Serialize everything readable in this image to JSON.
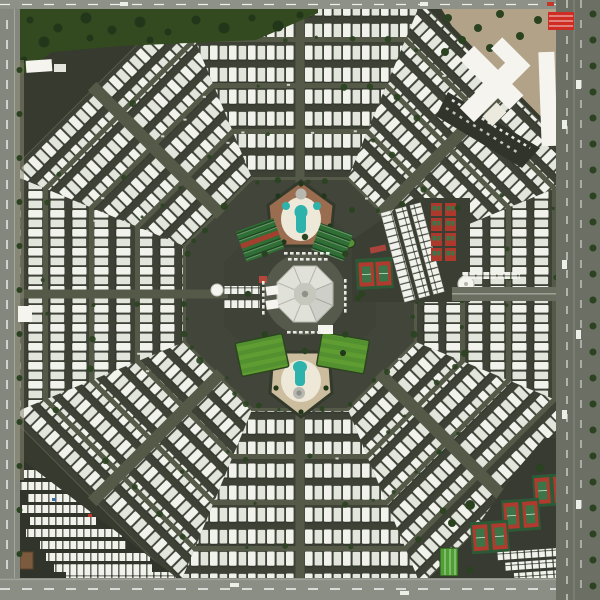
{
  "meta": {
    "type": "aerial-photograph",
    "subject": "Satellite view of an octagonal spiderweb-shaped mobile-home retirement community",
    "width_px": 600,
    "height_px": 600
  },
  "scene": {
    "colors": {
      "base": "#363a2f",
      "road": "#555948",
      "street": "#3d4136",
      "trailerA": "#f1f2ec",
      "trailerB": "#e2e5dc",
      "trailerShadow": "#20241c",
      "amenityBase": "#41453a",
      "hubBase": "#3f4337",
      "hubPlaza": "#565a4c",
      "parkGreen": "#33491f",
      "treeGreen": "#2a4220",
      "treeDark": "#22361a",
      "lawnA": "#5f9c31",
      "lawnB": "#539030",
      "canopyGreen": "#2f6e35",
      "canopyGap": "#1d4a22",
      "pool": "#2db3ac",
      "patioWhite": "#eee8d8",
      "terracotta": "#9a6c50",
      "tan": "#ccbd9e",
      "tennisPad": "#2d5a36",
      "tennisRed": "#b03a2e",
      "courtGreen": "#3c7547",
      "shuffleRed": "#ad382c",
      "roofWhite": "#e0e1d9",
      "roofEdge": "#b4b5ab",
      "roofInner": "#c6c7bd",
      "dirt": "#b1a288",
      "bldgWhite": "#f5f4ef",
      "redRoof": "#cf2d24",
      "asphalt": "#30342a",
      "zoneSE": "#373b31",
      "edgeRoadLeft": "#84877e",
      "edgeRoadBottom": "#8b8e85",
      "edgeRoadRight": "#6b6f64",
      "topRoad": "#8e9188",
      "shoulder": "#8a8672",
      "spa": "#b7b8b0",
      "shed": "#7b5a3e",
      "white": "#ffffff",
      "bocce": "#4f9f33",
      "redShed": "#a8443a"
    },
    "geometry": {
      "center": {
        "x": 300,
        "y": 294
      },
      "sectors": 8,
      "outer_apothem": 292,
      "amenity_apothem": 114,
      "hub_apothem": 76,
      "band_apothems": [
        [
          117,
          160
        ],
        [
          165,
          206
        ],
        [
          211,
          252
        ],
        [
          257,
          291
        ]
      ],
      "trailer_tile": {
        "w": 19,
        "h": 22
      }
    },
    "features": [
      {
        "name": "trailer-web",
        "label": "Concentric octagonal rings of white mobile homes"
      },
      {
        "name": "ring-roads",
        "label": "Octagonal ring roads between trailer bands"
      },
      {
        "name": "radial-roads",
        "label": "Eight radial streets from the center"
      },
      {
        "name": "central-clubhouse",
        "label": "Octagonal clubhouse with faceted white roof"
      },
      {
        "name": "clubhouse-parking",
        "label": "Parking rows around the clubhouse"
      },
      {
        "name": "north-pool-complex",
        "label": "North pool pentagon with teal pool and spas"
      },
      {
        "name": "south-pool-complex",
        "label": "South pool pentagon with teal pool and round spa"
      },
      {
        "name": "northwest-shade-canopies",
        "label": "Green shade-canopy rows (west)"
      },
      {
        "name": "northeast-shade-canopies",
        "label": "Green shade-canopy rows (east)"
      },
      {
        "name": "east-shuffleboard-courts",
        "label": "Red shuffleboard court block"
      },
      {
        "name": "east-storage-carports",
        "label": "Long white RV carport strips"
      },
      {
        "name": "east-tennis-courts",
        "label": "Tennis court pair east of center"
      },
      {
        "name": "water-tanks",
        "label": "Round white water tanks"
      },
      {
        "name": "southwest-lawn",
        "label": "Bright green lawn (southwest)"
      },
      {
        "name": "southeast-lawn",
        "label": "Bright green lawn (southeast)"
      },
      {
        "name": "north-park-strip",
        "label": "Tree-lined park strip along top edge"
      },
      {
        "name": "northeast-shopping-plaza",
        "label": "White-roofed shopping plaza on dirt lot"
      },
      {
        "name": "red-roof-building",
        "label": "Bright red-roofed building, top right"
      },
      {
        "name": "southwest-rv-storage-lot",
        "label": "Triangular RV storage lot, bottom left"
      },
      {
        "name": "southeast-tennis-courts",
        "label": "Three pairs of red tennis courts, bottom right"
      },
      {
        "name": "southeast-rv-parking",
        "label": "RV parking rows, bottom right"
      },
      {
        "name": "bocce-courts",
        "label": "Green bocce strip, bottom right"
      },
      {
        "name": "perimeter-roads",
        "label": "Roads along all four image edges"
      },
      {
        "name": "street-trees",
        "label": "Scattered dark green trees"
      }
    ]
  }
}
